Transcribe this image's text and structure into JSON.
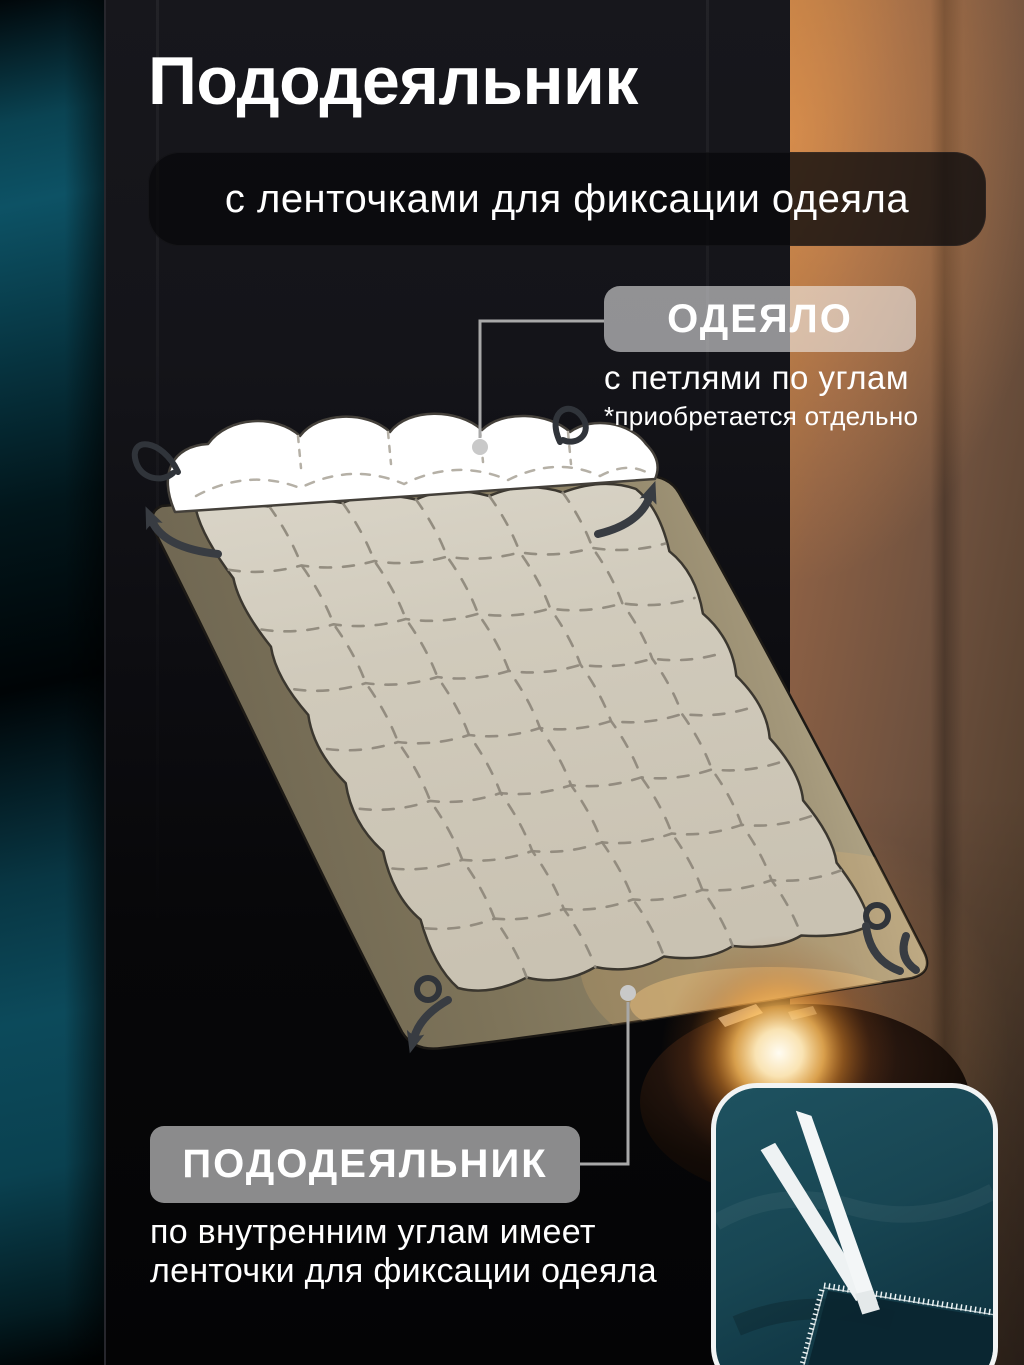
{
  "header": {
    "title": "Пододеяльник",
    "subtitle": "с ленточками для фиксации одеяла"
  },
  "callouts": {
    "blanket": {
      "label": "ОДЕЯЛО",
      "line1": "с петлями по углам",
      "line2": "*приобретается отдельно"
    },
    "duvet": {
      "label": "ПОДОДЕЯЛЬНИК",
      "line1": "по внутренним углам имеет",
      "line2": "ленточки для фиксации одеяла"
    }
  },
  "icons": {
    "callout_marker": "dot",
    "corner_arrow": "curved-arrow",
    "corner_loop": "loop-ring",
    "ribbons": "tied-white-ribbons"
  },
  "colors": {
    "text": "#ffffff",
    "banner_bg": "rgba(9,9,12,0.78)",
    "label_pill_bg": "rgba(244,244,244,0.56)",
    "connector": "#a8a8a8",
    "teal_fabric": "#0d4a5a",
    "dark_panel": "#121217",
    "curtain_brown": "#7a5640",
    "lamp_glow": "#ffd9a0",
    "duvet_cover_olive": "#8b7f63",
    "blanket_white": "#ffffff",
    "blanket_under_cover": "#d0cabb",
    "quilt_stitch": "#8f897c",
    "inset_fabric_teal": "#1a4a58",
    "inset_ribbon": "#eef2f3"
  }
}
